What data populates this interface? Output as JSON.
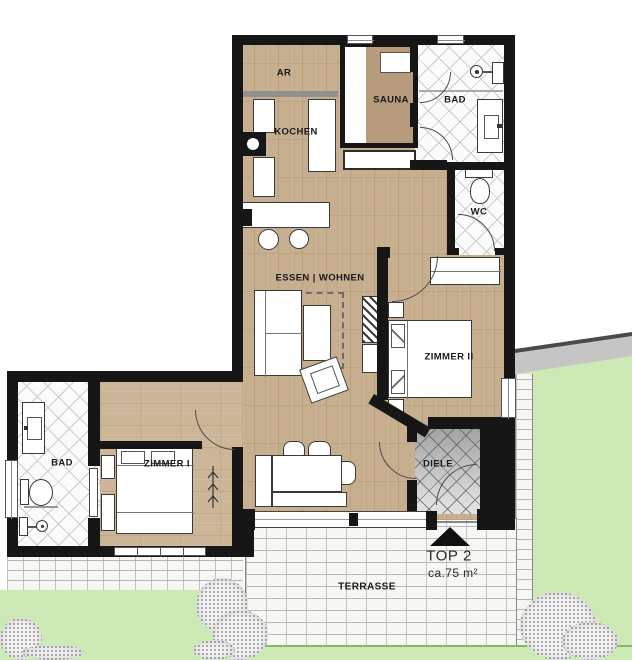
{
  "title": "TOP 2",
  "area_label": "ca.75 m²",
  "rooms": {
    "ar": "AR",
    "kochen": "KOCHEN",
    "sauna": "SAUNA",
    "bad_top": "BAD",
    "wc": "WC",
    "essen": "ESSEN | WOHNEN",
    "zimmer2": "ZIMMER II",
    "zimmer1": "ZIMMER I",
    "bad_left": "BAD",
    "diele": "DIELE"
  },
  "outdoor": {
    "terrasse": "TERRASSE"
  },
  "icons": {
    "entrance_marker": "black-triangle-up",
    "shower": "circle-with-dot",
    "toilet": "bowl-ellipse",
    "stove_flue": "black-square-white-circle",
    "plant": "branch-lines"
  },
  "colors": {
    "wall": "#161616",
    "wood_floor": "#c6ae8f",
    "sauna_wood": "#b89a7d",
    "bath_tile_line": "#cccccc",
    "diele_tile": "#9f9f9f",
    "lawn": "#cde9b6",
    "lawn_edge": "#84b768",
    "path_gray": "#c5c5c5",
    "terrace_base": "#f7f7f4"
  }
}
